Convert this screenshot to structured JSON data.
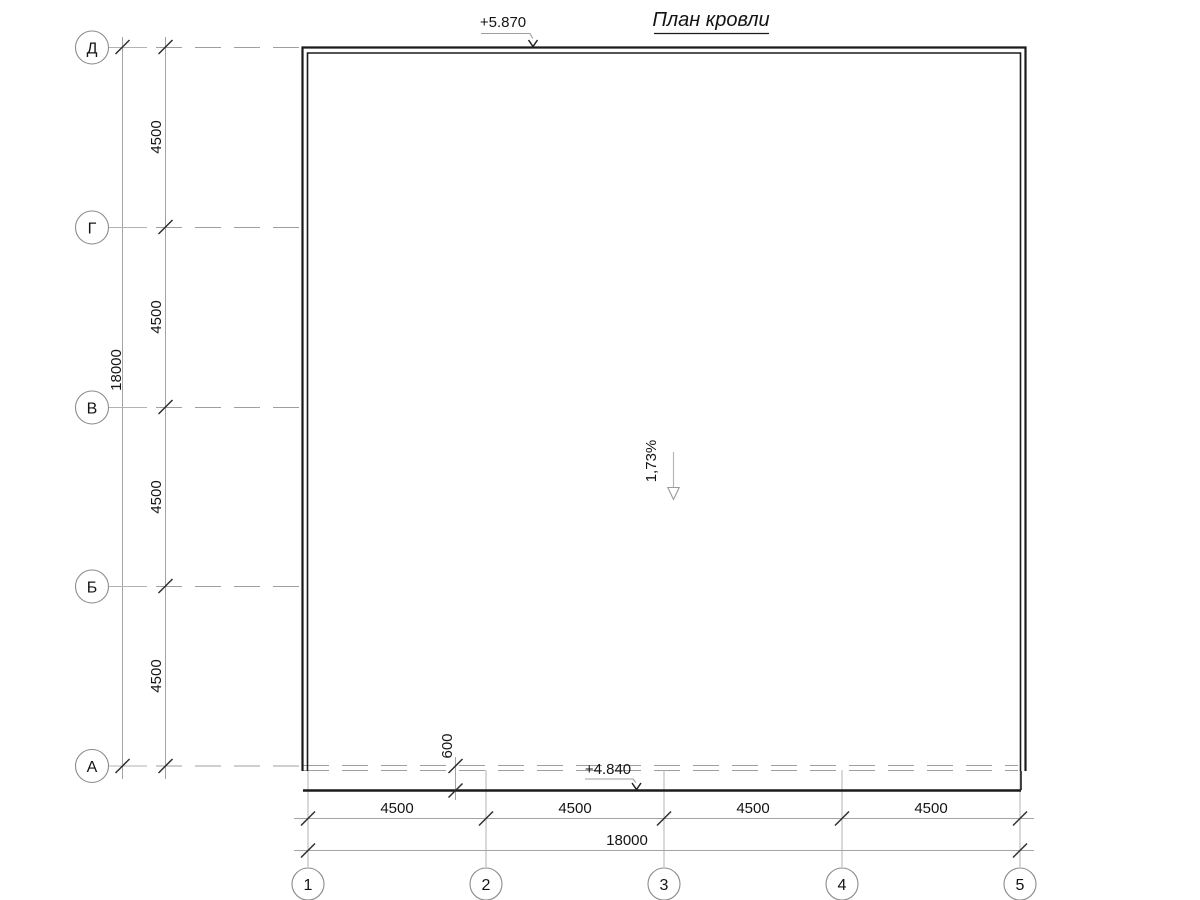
{
  "title": "План кровли",
  "annotations": {
    "elevation_top": "+5.870",
    "elevation_bottom": "+4.840",
    "slope_label": "1,73%",
    "overhang_dim": "600"
  },
  "axes_vertical": {
    "labels": [
      "Д",
      "Г",
      "В",
      "Б",
      "А"
    ],
    "segment_dims": [
      "4500",
      "4500",
      "4500",
      "4500"
    ],
    "total_dim": "18000"
  },
  "axes_horizontal": {
    "labels": [
      "1",
      "2",
      "3",
      "4",
      "5"
    ],
    "segment_dims": [
      "4500",
      "4500",
      "4500",
      "4500"
    ],
    "total_dim": "18000"
  },
  "colors": {
    "background": "#ffffff",
    "outline": "#1b1b1b",
    "dimension_line": "#a3a3a3",
    "extension_line": "#b3b3b3",
    "tick": "#2e2e2e",
    "text": "#141414"
  }
}
